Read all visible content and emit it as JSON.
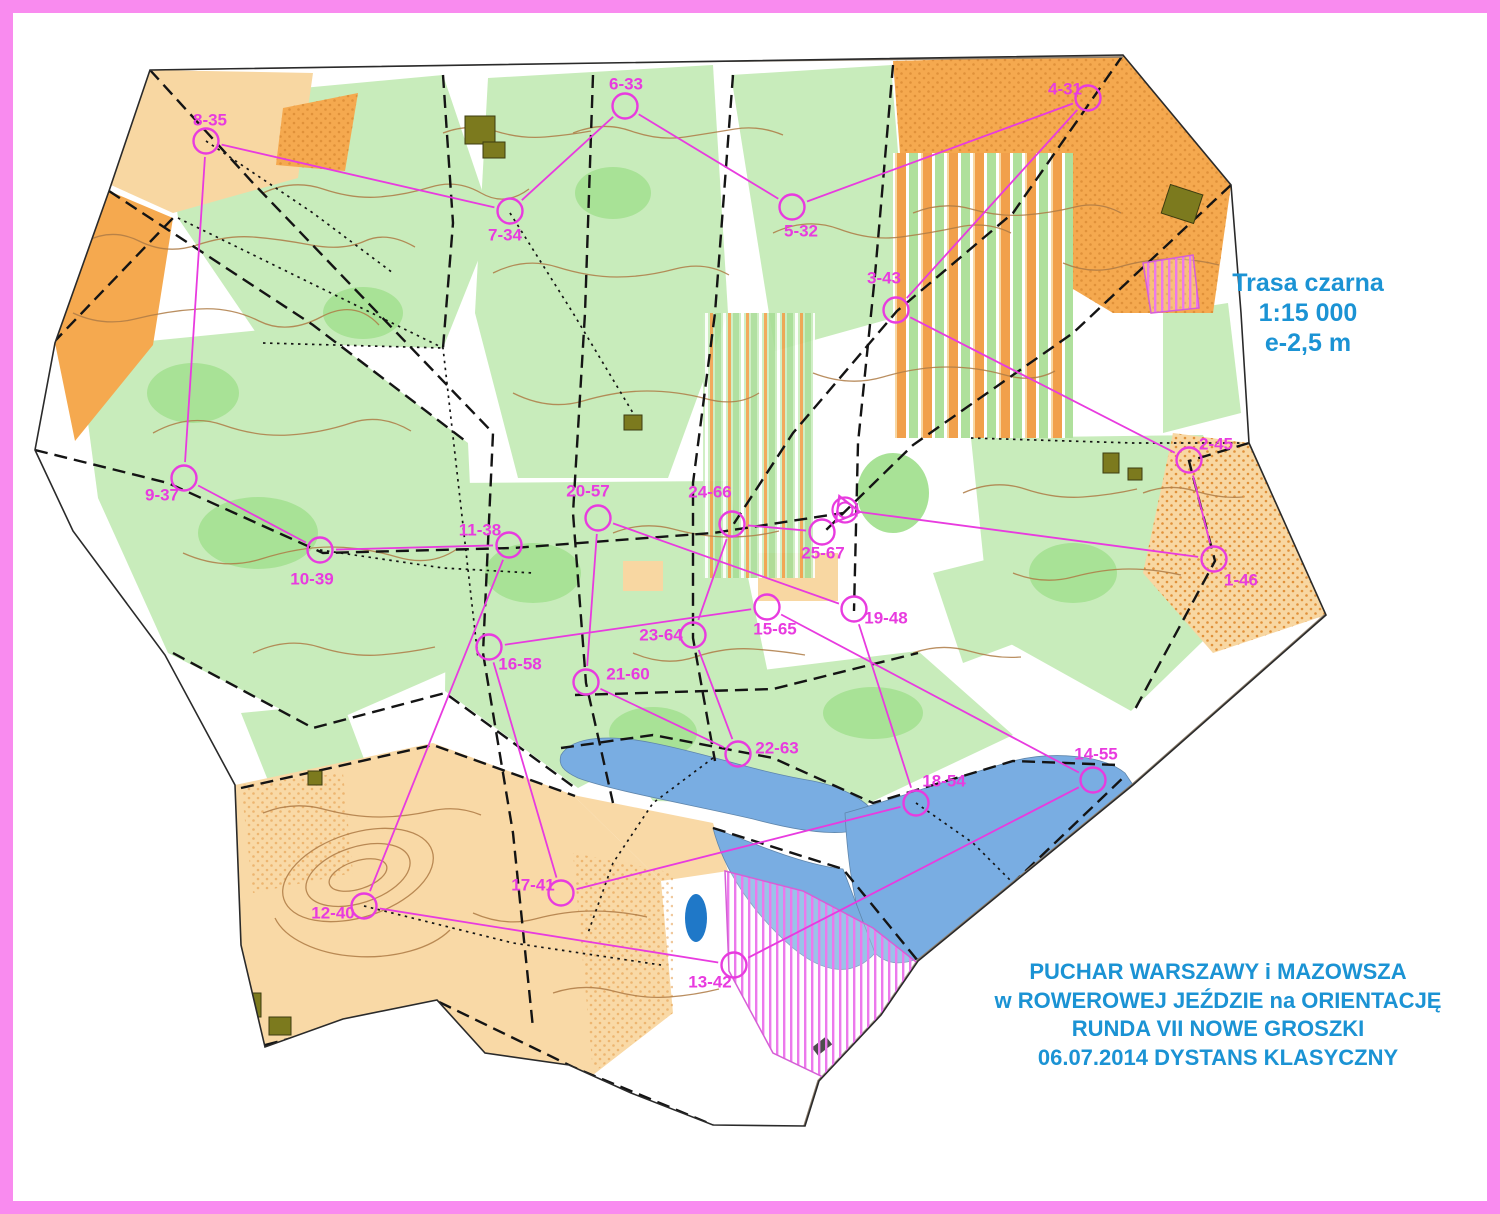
{
  "frame_color": "#F98BEF",
  "info_box": {
    "color": "#1B93D4",
    "lines": [
      "Trasa czarna",
      "1:15 000",
      "e-2,5 m"
    ]
  },
  "event_box": {
    "color": "#1B93D4",
    "lines": [
      "PUCHAR WARSZAWY i MAZOWSZA",
      "w ROWEROWEJ JEŹDZIE na ORIENTACJĘ",
      "RUNDA VII NOWE GROSZKI",
      "06.07.2014 DYSTANS KLASYCZNY"
    ]
  },
  "course": {
    "color": "#E83BDF",
    "circle_radius": 12.5,
    "start_finish": {
      "x": 832,
      "y": 497
    },
    "controls": [
      {
        "label": "1-46",
        "x": 1201,
        "y": 546,
        "lx": 1228,
        "ly": 567
      },
      {
        "label": "2-45",
        "x": 1176,
        "y": 447,
        "lx": 1203,
        "ly": 431
      },
      {
        "label": "3-43",
        "x": 883,
        "y": 297,
        "lx": 871,
        "ly": 265
      },
      {
        "label": "4-31",
        "x": 1075,
        "y": 85,
        "lx": 1052,
        "ly": 76
      },
      {
        "label": "5-32",
        "x": 779,
        "y": 194,
        "lx": 788,
        "ly": 218
      },
      {
        "label": "6-33",
        "x": 612,
        "y": 93,
        "lx": 613,
        "ly": 71
      },
      {
        "label": "7-34",
        "x": 497,
        "y": 198,
        "lx": 492,
        "ly": 222
      },
      {
        "label": "8-35",
        "x": 193,
        "y": 128,
        "lx": 197,
        "ly": 107
      },
      {
        "label": "9-37",
        "x": 171,
        "y": 465,
        "lx": 149,
        "ly": 482
      },
      {
        "label": "10-39",
        "x": 307,
        "y": 537,
        "lx": 299,
        "ly": 566
      },
      {
        "label": "11-38",
        "x": 496,
        "y": 532,
        "lx": 467,
        "ly": 517
      },
      {
        "label": "12-40",
        "x": 351,
        "y": 893,
        "lx": 320,
        "ly": 900
      },
      {
        "label": "13-42",
        "x": 721,
        "y": 952,
        "lx": 697,
        "ly": 969
      },
      {
        "label": "14-55",
        "x": 1080,
        "y": 767,
        "lx": 1083,
        "ly": 741
      },
      {
        "label": "15-65",
        "x": 754,
        "y": 594,
        "lx": 762,
        "ly": 616
      },
      {
        "label": "16-58",
        "x": 476,
        "y": 634,
        "lx": 507,
        "ly": 651
      },
      {
        "label": "17-41",
        "x": 548,
        "y": 880,
        "lx": 520,
        "ly": 872
      },
      {
        "label": "18-54",
        "x": 903,
        "y": 790,
        "lx": 931,
        "ly": 768
      },
      {
        "label": "19-48",
        "x": 841,
        "y": 596,
        "lx": 873,
        "ly": 605
      },
      {
        "label": "20-57",
        "x": 585,
        "y": 505,
        "lx": 575,
        "ly": 478
      },
      {
        "label": "21-60",
        "x": 573,
        "y": 669,
        "lx": 615,
        "ly": 661
      },
      {
        "label": "22-63",
        "x": 725,
        "y": 741,
        "lx": 764,
        "ly": 735
      },
      {
        "label": "23-64",
        "x": 680,
        "y": 622,
        "lx": 648,
        "ly": 622
      },
      {
        "label": "24-66",
        "x": 719,
        "y": 511,
        "lx": 697,
        "ly": 479
      },
      {
        "label": "25-67",
        "x": 809,
        "y": 519,
        "lx": 810,
        "ly": 540
      }
    ]
  }
}
